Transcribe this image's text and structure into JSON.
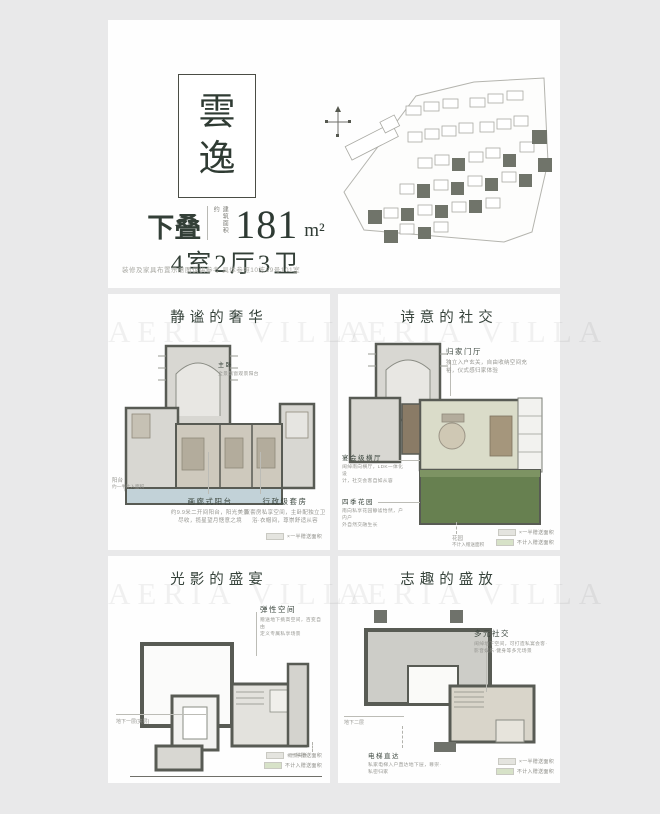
{
  "header": {
    "brand_char_1": "雲",
    "brand_char_2": "逸",
    "product_type": "下叠",
    "area_label": "建筑面积约",
    "area_value": "181",
    "area_unit": "m²",
    "layout_text": "4室2厅3卫",
    "disclaimer": "装修及家具布置示意图仅供参考 具体参照10栋29号101室"
  },
  "watermark": "AERIA VILLA",
  "legend": {
    "half_area": "×一半赠送面积",
    "not_counted": "不计入赠送面积"
  },
  "panels": [
    {
      "title": "静谧的奢华",
      "note": {
        "title": "主卧",
        "desc": "全景飘窗观景阳台"
      },
      "side_note": {
        "title": "阳台",
        "desc": "约一半计入面积"
      },
      "a1": {
        "title": "画廊式阳台",
        "desc1": "约9.9米二开间阳台，阳光美景",
        "desc2": "尽收，揽星望月惬意之境"
      },
      "a2": {
        "title": "行政级套房",
        "desc1": "双套房私享空间，主卧配独立卫",
        "desc2": "浴·衣帽间，尊崇舒适从容"
      }
    },
    {
      "title": "诗意的社交",
      "a1": {
        "title": "归家门厅",
        "desc1": "独立入户玄关，自由收纳空间充",
        "desc2": "裕，仪式感归家体验"
      },
      "a2": {
        "title": "宴会级横厅",
        "desc1": "阔绰南向横厅，LDK一体化设",
        "desc2": "计，社交会客自如从容"
      },
      "a3": {
        "title": "四季花园",
        "desc1": "南向私享花园静谧怡然，户内户",
        "desc2": "外自然交融生长"
      },
      "note": {
        "title": "花园",
        "desc": "不计入赠送面积"
      }
    },
    {
      "title": "光影的盛宴",
      "a1": {
        "title": "弹性空间",
        "desc1": "赠送地下挑高空间，百变自由",
        "desc2": "定义专属私享场景"
      },
      "floor_label": "地下一层(夹层)",
      "note": "观景天井"
    },
    {
      "title": "志趣的盛放",
      "a1": {
        "title": "多元社交",
        "desc1": "阔绰地下空间，可打造私宴会客·",
        "desc2": "影音娱乐·健身等多元场景"
      },
      "floor_label": "地下二层",
      "a2": {
        "title": "电梯直达",
        "desc1": "私家电梯入户直达地下层，尊崇·",
        "desc2": "私密归家"
      }
    }
  ]
}
